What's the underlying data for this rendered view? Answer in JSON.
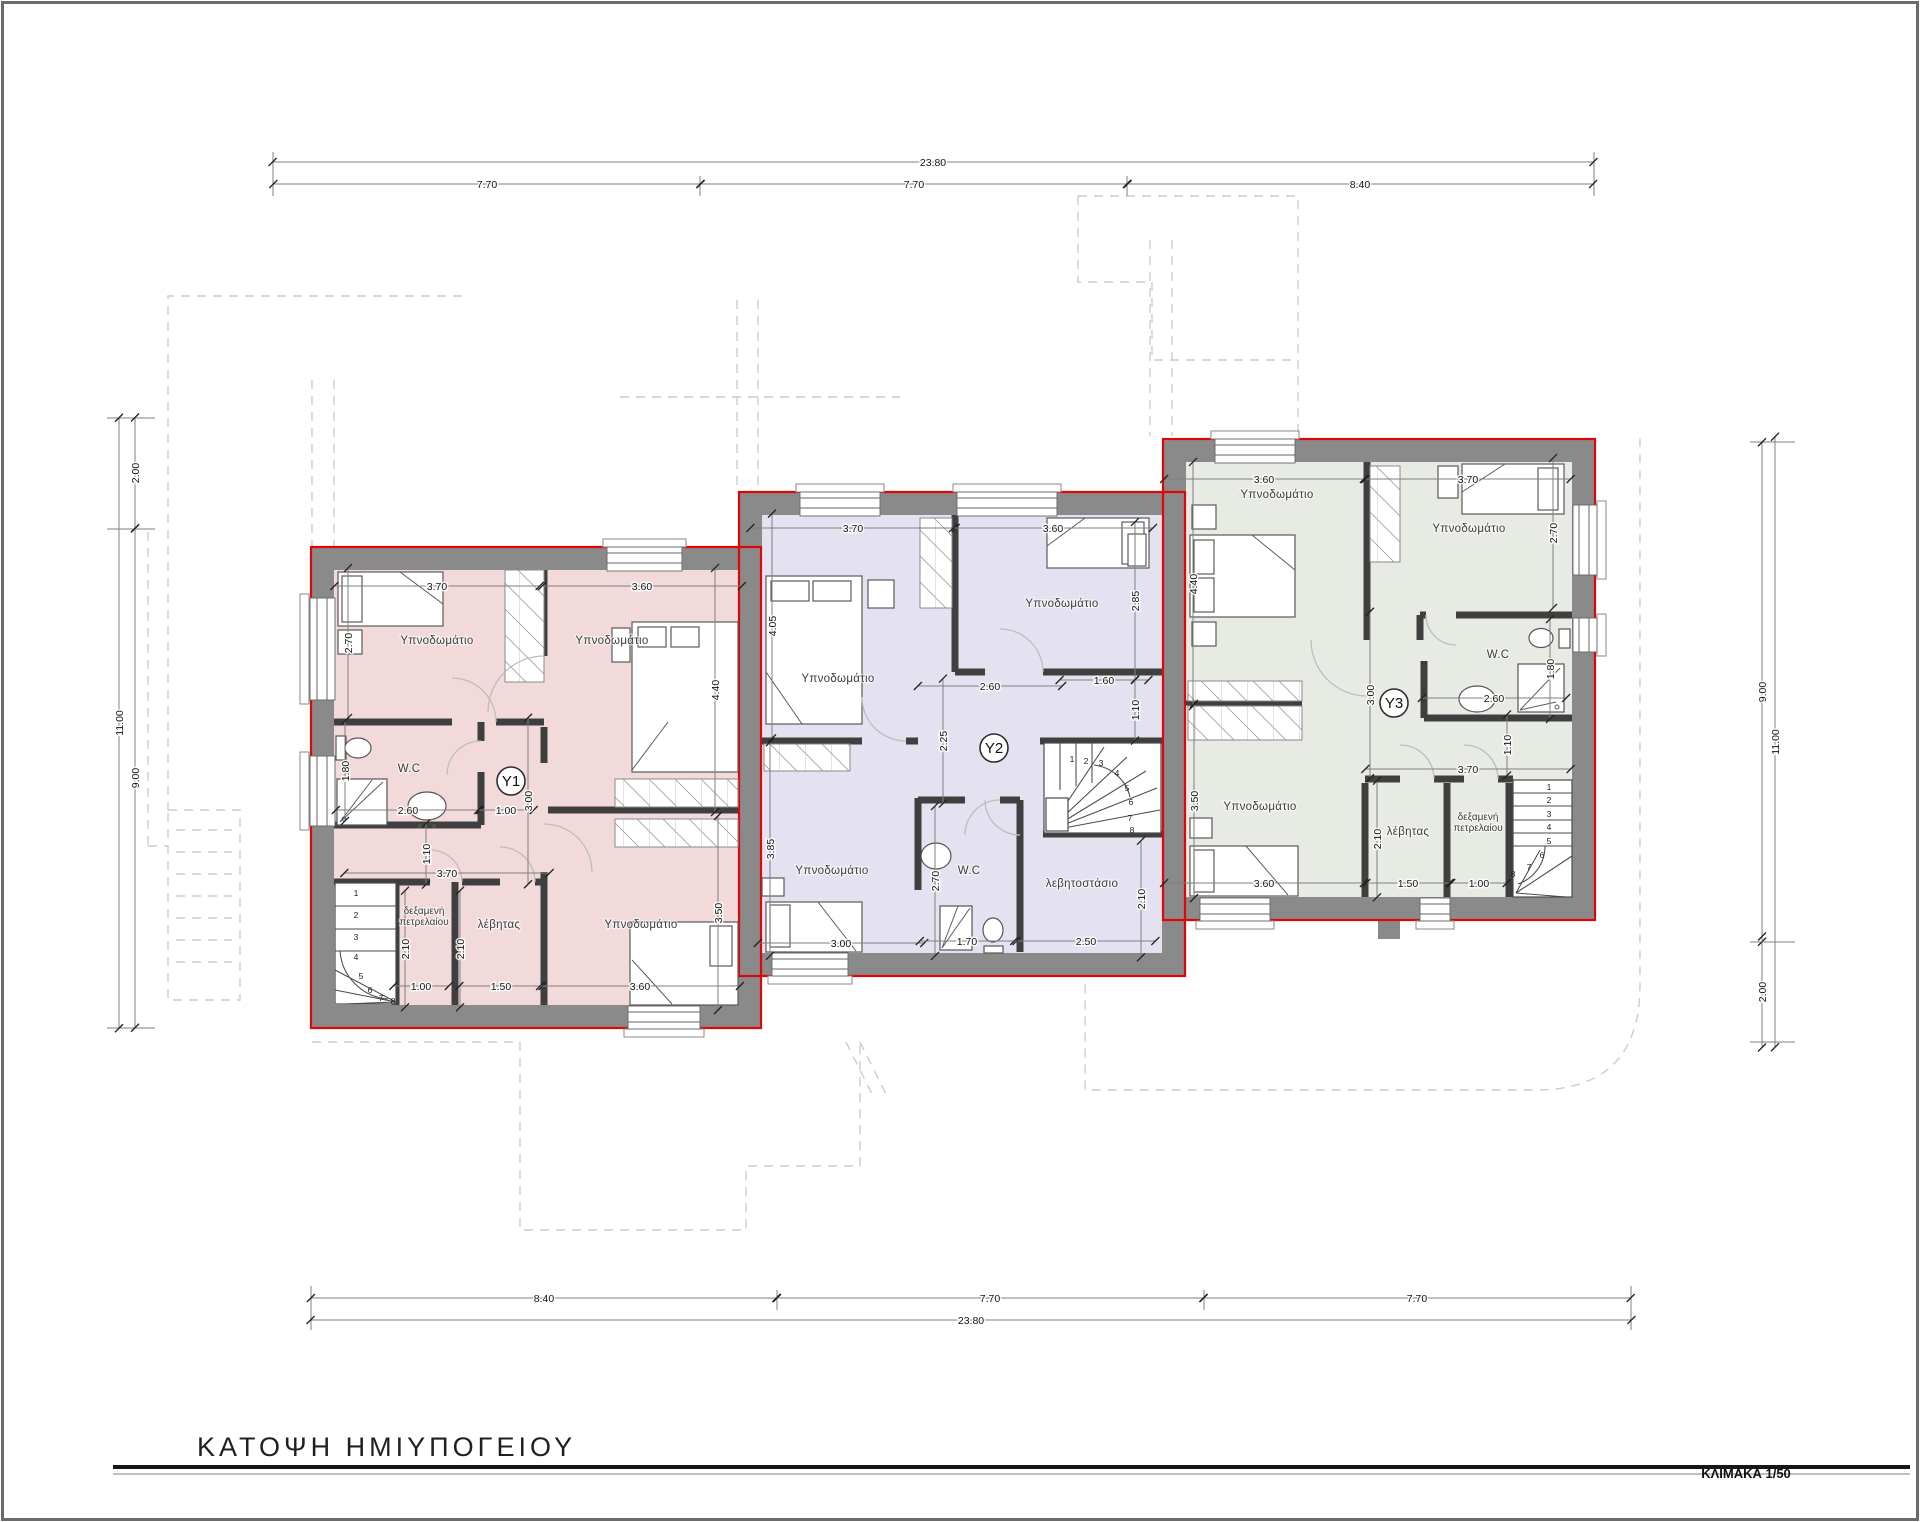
{
  "sheet": {
    "title": "ΚΑΤΟΨΗ ΗΜΙΥΠΟΓΕΙΟΥ",
    "scale_label": "ΚΛΙΜΑΚΑ 1/50"
  },
  "palette": {
    "wall": "#8a8a8a",
    "partition": "#3f3f3f",
    "outline_red": "#e30505",
    "dashed": "#cccccc"
  },
  "units": [
    {
      "id": "Y1",
      "color": "#f2dada"
    },
    {
      "id": "Y2",
      "color": "#e4e2f1"
    },
    {
      "id": "Y3",
      "color": "#e7ebe4"
    }
  ],
  "labels": {
    "sheet_dims": [
      {
        "t": "23.80",
        "x": 933,
        "y": 166
      },
      {
        "t": "7.70",
        "x": 487,
        "y": 188
      },
      {
        "t": "7.70",
        "x": 914,
        "y": 188
      },
      {
        "t": "8.40",
        "x": 1360,
        "y": 188
      },
      {
        "t": "8.40",
        "x": 544,
        "y": 1302
      },
      {
        "t": "7.70",
        "x": 990,
        "y": 1302
      },
      {
        "t": "7.70",
        "x": 1417,
        "y": 1302
      },
      {
        "t": "23.80",
        "x": 971,
        "y": 1324
      },
      {
        "t": "11.00",
        "x": 123,
        "y": 723,
        "r": 1
      },
      {
        "t": "2.00",
        "x": 139,
        "y": 473,
        "r": 1
      },
      {
        "t": "9.00",
        "x": 139,
        "y": 778,
        "r": 1
      },
      {
        "t": "9.00",
        "x": 1766,
        "y": 692,
        "r": 1
      },
      {
        "t": "2.00",
        "x": 1766,
        "y": 992,
        "r": 1
      },
      {
        "t": "11.00",
        "x": 1779,
        "y": 742,
        "r": 1
      }
    ],
    "y1": [
      {
        "t": "Υπνοδωμάτιο",
        "k": "room",
        "x": 437,
        "y": 644
      },
      {
        "t": "Υπνοδωμάτιο",
        "k": "room",
        "x": 612,
        "y": 644
      },
      {
        "t": "W.C",
        "k": "room",
        "x": 409,
        "y": 772
      },
      {
        "t": "δεξαμενή πετρελαίου",
        "k": "room2",
        "x": 424,
        "y": 914,
        "lines": [
          "δεξαμενή",
          "πετρελαίου"
        ]
      },
      {
        "t": "λέβητας",
        "k": "room",
        "x": 499,
        "y": 928
      },
      {
        "t": "Υπνοδωμάτιο",
        "k": "room",
        "x": 641,
        "y": 928
      },
      {
        "t": "Y1",
        "k": "unit",
        "x": 511,
        "y": 781
      },
      {
        "t": "3.70",
        "x": 437,
        "y": 590
      },
      {
        "t": "2.70",
        "x": 352,
        "y": 643,
        "r": 1
      },
      {
        "t": "3.60",
        "x": 642,
        "y": 590
      },
      {
        "t": "4.40",
        "x": 719,
        "y": 690,
        "r": 1
      },
      {
        "t": "1.80",
        "x": 349,
        "y": 771,
        "r": 1
      },
      {
        "t": "2.60",
        "x": 408,
        "y": 814
      },
      {
        "t": "3.00",
        "x": 532,
        "y": 801,
        "r": 1
      },
      {
        "t": "1.00",
        "x": 506,
        "y": 814
      },
      {
        "t": "1.10",
        "x": 430,
        "y": 854,
        "r": 1
      },
      {
        "t": "3.70",
        "x": 447,
        "y": 877
      },
      {
        "t": "2.10",
        "x": 409,
        "y": 949,
        "r": 1
      },
      {
        "t": "2.10",
        "x": 464,
        "y": 949,
        "r": 1
      },
      {
        "t": "1.00",
        "x": 421,
        "y": 990
      },
      {
        "t": "1.50",
        "x": 501,
        "y": 990
      },
      {
        "t": "3.60",
        "x": 640,
        "y": 990
      },
      {
        "t": "3.50",
        "x": 722,
        "y": 913,
        "r": 1
      },
      {
        "t": "1",
        "k": "step",
        "x": 356,
        "y": 896
      },
      {
        "t": "2",
        "k": "step",
        "x": 356,
        "y": 918
      },
      {
        "t": "3",
        "k": "step",
        "x": 356,
        "y": 940
      },
      {
        "t": "4",
        "k": "step",
        "x": 356,
        "y": 960
      },
      {
        "t": "5",
        "k": "step",
        "x": 361,
        "y": 979
      },
      {
        "t": "6",
        "k": "step",
        "x": 370,
        "y": 993
      },
      {
        "t": "7",
        "k": "step",
        "x": 381,
        "y": 1001
      },
      {
        "t": "8",
        "k": "step",
        "x": 393,
        "y": 1004
      }
    ],
    "y2": [
      {
        "t": "Υπνοδωμάτιο",
        "k": "room",
        "x": 838,
        "y": 682
      },
      {
        "t": "Υπνοδωμάτιο",
        "k": "room",
        "x": 1062,
        "y": 607
      },
      {
        "t": "Υπνοδωμάτιο",
        "k": "room",
        "x": 832,
        "y": 874
      },
      {
        "t": "W.C",
        "k": "room",
        "x": 969,
        "y": 874
      },
      {
        "t": "λεβητοστάσιο",
        "k": "room",
        "x": 1082,
        "y": 887
      },
      {
        "t": "Y2",
        "k": "unit",
        "x": 994,
        "y": 748
      },
      {
        "t": "3.70",
        "x": 853,
        "y": 532
      },
      {
        "t": "4.05",
        "x": 776,
        "y": 626,
        "r": 1
      },
      {
        "t": "3.60",
        "x": 1053,
        "y": 532
      },
      {
        "t": "2.85",
        "x": 1139,
        "y": 601,
        "r": 1
      },
      {
        "t": "2.60",
        "x": 990,
        "y": 690
      },
      {
        "t": "1.60",
        "x": 1104,
        "y": 684
      },
      {
        "t": "2.25",
        "x": 947,
        "y": 741,
        "r": 1
      },
      {
        "t": "1.10",
        "x": 1139,
        "y": 710,
        "r": 1
      },
      {
        "t": "3.85",
        "x": 774,
        "y": 849,
        "r": 1
      },
      {
        "t": "3.00",
        "x": 841,
        "y": 947
      },
      {
        "t": "2.70",
        "x": 939,
        "y": 881,
        "r": 1
      },
      {
        "t": "1.70",
        "x": 967,
        "y": 945
      },
      {
        "t": "2.50",
        "x": 1086,
        "y": 945
      },
      {
        "t": "2.10",
        "x": 1145,
        "y": 899,
        "r": 1
      },
      {
        "t": "1",
        "k": "step",
        "x": 1072,
        "y": 762
      },
      {
        "t": "2",
        "k": "step",
        "x": 1086,
        "y": 764
      },
      {
        "t": "3",
        "k": "step",
        "x": 1101,
        "y": 766
      },
      {
        "t": "4",
        "k": "step",
        "x": 1117,
        "y": 776
      },
      {
        "t": "5",
        "k": "step",
        "x": 1127,
        "y": 791
      },
      {
        "t": "6",
        "k": "step",
        "x": 1131,
        "y": 805
      },
      {
        "t": "7",
        "k": "step",
        "x": 1130,
        "y": 821
      },
      {
        "t": "8",
        "k": "step",
        "x": 1132,
        "y": 833
      }
    ],
    "y3": [
      {
        "t": "Υπνοδωμάτιο",
        "k": "room",
        "x": 1277,
        "y": 498
      },
      {
        "t": "Υπνοδωμάτιο",
        "k": "room",
        "x": 1469,
        "y": 532
      },
      {
        "t": "Υπνοδωμάτιο",
        "k": "room",
        "x": 1260,
        "y": 810
      },
      {
        "t": "W.C",
        "k": "room",
        "x": 1498,
        "y": 658
      },
      {
        "t": "λέβητας",
        "k": "room",
        "x": 1408,
        "y": 835
      },
      {
        "t": "δεξαμενή πετρελαίου",
        "k": "room2",
        "x": 1478,
        "y": 820,
        "lines": [
          "δεξαμενή",
          "πετρελαίου"
        ]
      },
      {
        "t": "Y3",
        "k": "unit",
        "x": 1394,
        "y": 703
      },
      {
        "t": "3.60",
        "x": 1264,
        "y": 483
      },
      {
        "t": "4.40",
        "x": 1197,
        "y": 584,
        "r": 1
      },
      {
        "t": "3.70",
        "x": 1468,
        "y": 483
      },
      {
        "t": "2.70",
        "x": 1557,
        "y": 533,
        "r": 1
      },
      {
        "t": "2.60",
        "x": 1494,
        "y": 702
      },
      {
        "t": "1.80",
        "x": 1554,
        "y": 669,
        "r": 1
      },
      {
        "t": "3.00",
        "x": 1374,
        "y": 695,
        "r": 1
      },
      {
        "t": "1.10",
        "x": 1511,
        "y": 745,
        "r": 1
      },
      {
        "t": "3.70",
        "x": 1468,
        "y": 773
      },
      {
        "t": "3.50",
        "x": 1198,
        "y": 801,
        "r": 1
      },
      {
        "t": "3.60",
        "x": 1264,
        "y": 887
      },
      {
        "t": "2.10",
        "x": 1381,
        "y": 839,
        "r": 1
      },
      {
        "t": "1.50",
        "x": 1408,
        "y": 887
      },
      {
        "t": "1.00",
        "x": 1479,
        "y": 887
      },
      {
        "t": "1",
        "k": "step",
        "x": 1549,
        "y": 790
      },
      {
        "t": "2",
        "k": "step",
        "x": 1549,
        "y": 803
      },
      {
        "t": "3",
        "k": "step",
        "x": 1549,
        "y": 817
      },
      {
        "t": "4",
        "k": "step",
        "x": 1549,
        "y": 830
      },
      {
        "t": "5",
        "k": "step",
        "x": 1549,
        "y": 844
      },
      {
        "t": "6",
        "k": "step",
        "x": 1542,
        "y": 858
      },
      {
        "t": "7",
        "k": "step",
        "x": 1529,
        "y": 870
      },
      {
        "t": "8",
        "k": "step",
        "x": 1513,
        "y": 877
      }
    ]
  }
}
